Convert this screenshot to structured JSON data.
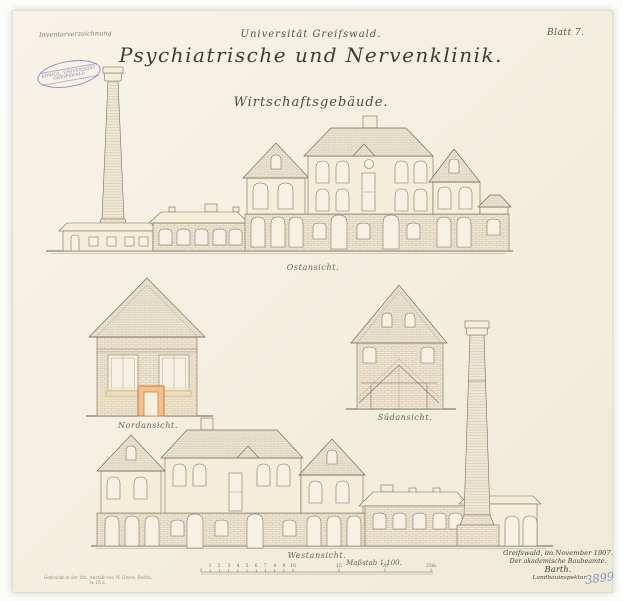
{
  "sheet": {
    "archive_note": "Inventarverzeichnung",
    "sheet_number": "Blatt 7.",
    "stamp": {
      "line1": "KÖNIGL. UNIVERSITÄT",
      "line2": "GREIFSWALD"
    },
    "registry_number": "3899",
    "imprint_line1": "Gedruckt in der lith. Anstalt von W. Greve, Berlin.",
    "imprint_line2": "№ 15 a."
  },
  "title": {
    "institution": "Universität Greifswald.",
    "main": "Psychiatrische und Nervenklinik.",
    "subtitle": "Wirtschaftsgebäude."
  },
  "views": [
    {
      "id": "ost",
      "label": "Ostansicht."
    },
    {
      "id": "nord",
      "label": "Nordansicht."
    },
    {
      "id": "sued",
      "label": "Südansicht."
    },
    {
      "id": "west",
      "label": "Westansicht."
    }
  ],
  "scale_bar": {
    "label": "Maßstab 1:100.",
    "ticks": [
      "1",
      "2",
      "3",
      "4",
      "5",
      "6",
      "7",
      "8",
      "9",
      "10",
      "15",
      "20",
      "25m"
    ]
  },
  "signature": {
    "place_date": "Greifswald, im November 1907.",
    "office": "Der akademische Baubeamte.",
    "name": "Barth.",
    "rank": "Landbauinspektor."
  }
}
